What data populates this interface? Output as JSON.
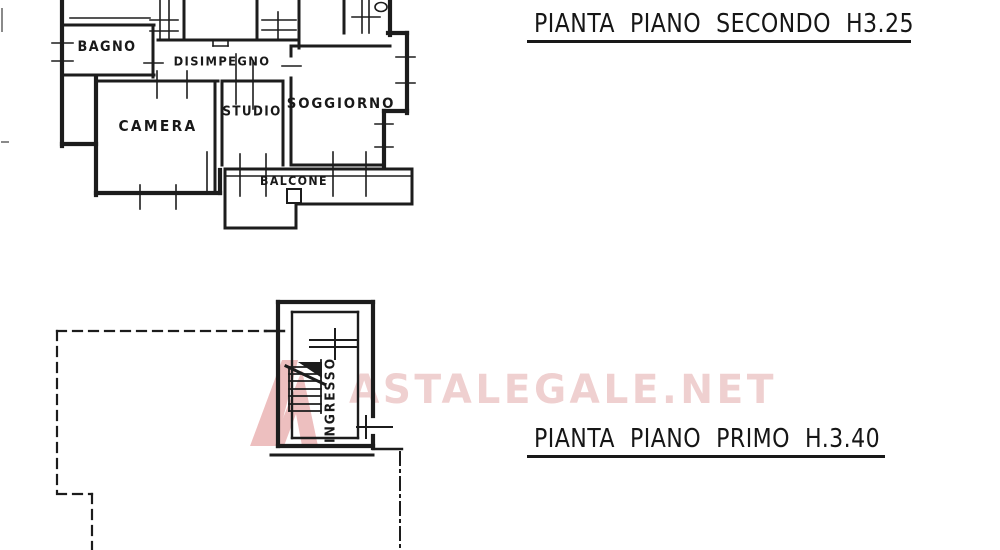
{
  "colors": {
    "ink": "#1f1f1f",
    "paper": "#ffffff",
    "watermark_pink": "#e9c6c6"
  },
  "watermark": {
    "text": "ASTALEGALE.NET",
    "logo_icon": "astalegale-logo"
  },
  "floor2": {
    "title": "PIANTA PIANO SECONDO H3.25",
    "rooms": {
      "bagno": "BAGNO",
      "disimpegno": "DISIMPEGNO",
      "camera": "CAMERA",
      "studio": "STUDIO",
      "soggiorno": "SOGGIORNO",
      "balcone": "BALCONE"
    }
  },
  "floor1": {
    "title": "PIANTA PIANO PRIMO H.3.40",
    "rooms": {
      "ingresso": "INGRESSO"
    }
  }
}
